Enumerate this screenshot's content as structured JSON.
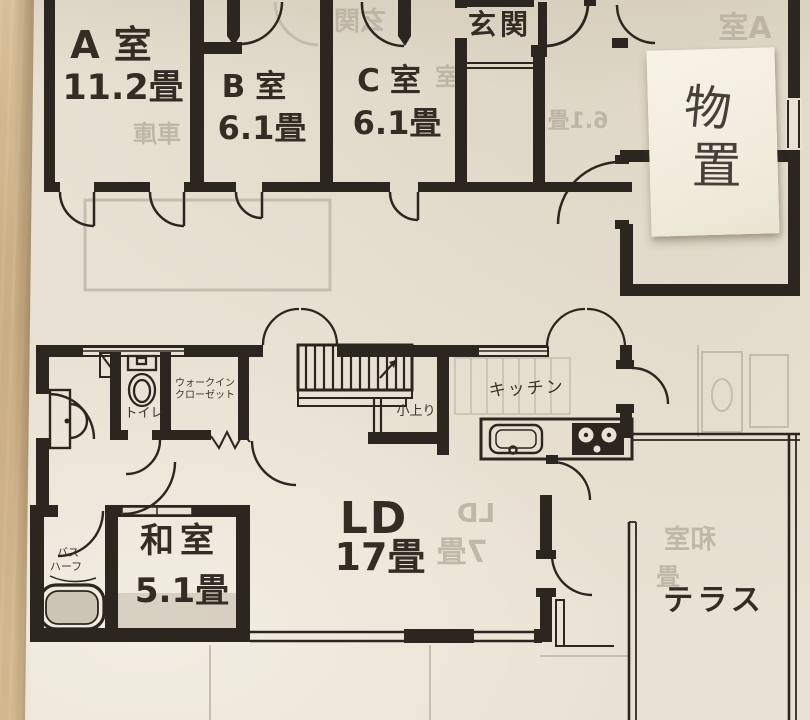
{
  "colors": {
    "paper": "#e9e2d4",
    "ink": "#2b2620",
    "wood_table": "#cdb28a",
    "sticky_note": "#f4f0e2",
    "show_through": "#b9b0a1"
  },
  "upper_floor": {
    "room_a": {
      "label": "A室",
      "size": "11.2畳"
    },
    "room_b": {
      "label": "B室",
      "size": "6.1畳"
    },
    "room_c": {
      "label": "C室",
      "size": "6.1畳"
    },
    "entrance": {
      "label": "玄関"
    }
  },
  "sticky_note": {
    "char_top": "物",
    "char_bottom": "置"
  },
  "lower_floor": {
    "toilet": {
      "label": "トイレ"
    },
    "walk_in_closet": {
      "label_line1": "ウォークイン",
      "label_line2": "クローゼット"
    },
    "koagari": {
      "label": "小上り"
    },
    "kitchen": {
      "label": "キッチン"
    },
    "washitsu": {
      "label": "和室",
      "size": "5.1畳"
    },
    "bath": {
      "label_line1": "バス",
      "label_line2": "ハーフ"
    },
    "living_dining": {
      "label": "LD",
      "size": "17畳"
    },
    "terrace": {
      "label": "テラス"
    }
  },
  "show_through": {
    "texts": [
      "A室",
      "玄関",
      "室",
      "6.1畳",
      "車庫",
      "LD",
      "7畳",
      "和室",
      "畳"
    ]
  }
}
